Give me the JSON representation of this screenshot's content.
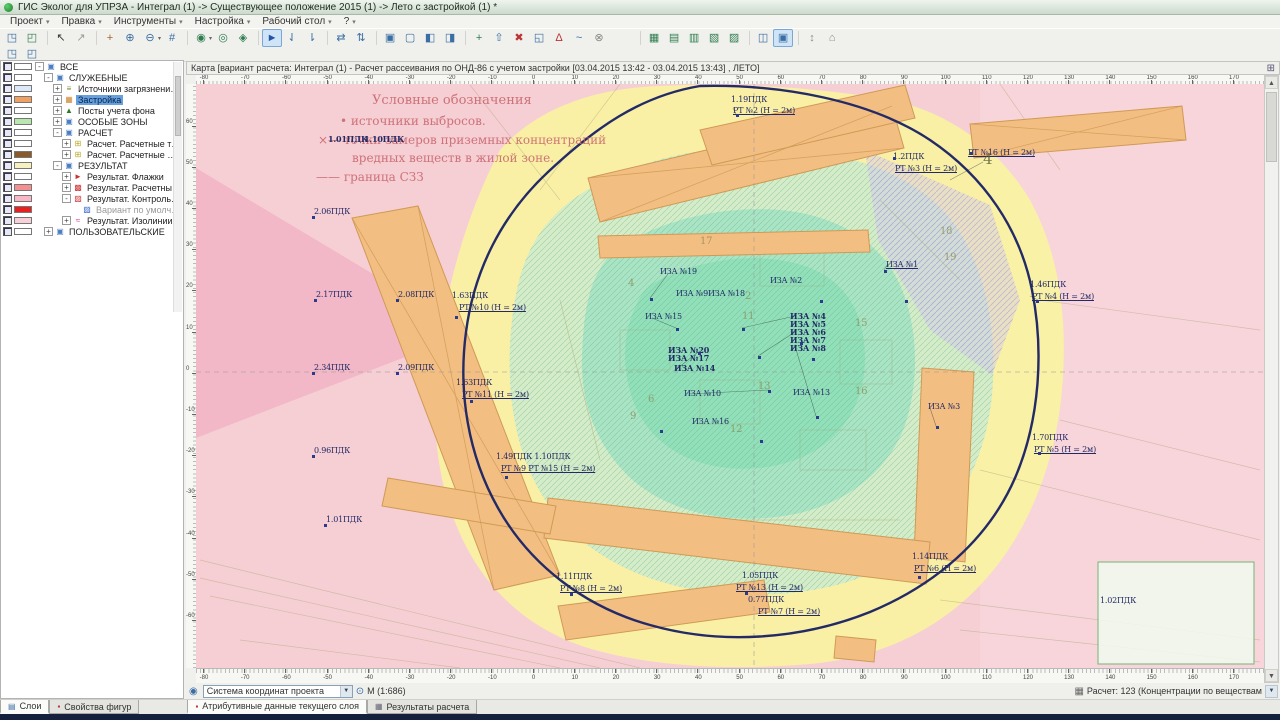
{
  "window": {
    "title": "ГИС Эколог для УПРЗА - Интеграл (1) -> Существующее положение 2015 (1) -> Лето с застройкой (1) *"
  },
  "menu": {
    "items": [
      "Проект",
      "Правка",
      "Инструменты",
      "Настройка",
      "Рабочий стол",
      "?"
    ]
  },
  "toolbar": {
    "rows": [
      [
        [
          {
            "g": "◳",
            "c": "#3a6ea5"
          },
          {
            "g": "◰",
            "c": "#2e7d4f"
          }
        ],
        [
          {
            "g": "↖",
            "c": "#333333"
          },
          {
            "g": "↗",
            "c": "#999999"
          }
        ],
        [
          {
            "g": "+",
            "c": "#a06a2a"
          },
          {
            "g": "⊕",
            "c": "#3a6ea5"
          },
          {
            "g": "⊖",
            "c": "#3a6ea5",
            "dd": true
          },
          {
            "g": "#",
            "c": "#3a6ea5"
          }
        ],
        [
          {
            "g": "◉",
            "c": "#2e7d4f",
            "dd": true
          },
          {
            "g": "◎",
            "c": "#2e7d4f"
          },
          {
            "g": "◈",
            "c": "#2e7d4f"
          }
        ],
        [
          {
            "g": "►",
            "c": "#2255aa",
            "boxed": true
          },
          {
            "g": "⇃",
            "c": "#3a6ea5"
          },
          {
            "g": "⇂",
            "c": "#3a6ea5"
          }
        ],
        [
          {
            "g": "⇄",
            "c": "#3a6ea5"
          },
          {
            "g": "⇅",
            "c": "#3a6ea5"
          }
        ],
        [
          {
            "g": "▣",
            "c": "#3a6ea5"
          },
          {
            "g": "▢",
            "c": "#3a6ea5"
          },
          {
            "g": "◧",
            "c": "#3a6ea5"
          },
          {
            "g": "◨",
            "c": "#3a6ea5"
          }
        ],
        [
          {
            "g": "+",
            "c": "#2e7d4f"
          },
          {
            "g": "⇧",
            "c": "#3a6ea5"
          },
          {
            "g": "✖",
            "c": "#bb3333"
          },
          {
            "g": "◱",
            "c": "#3a6ea5"
          },
          {
            "g": "Δ",
            "c": "#bb3333"
          },
          {
            "g": "~",
            "c": "#3a6ea5"
          },
          {
            "g": "⊗",
            "c": "#888888"
          }
        ],
        [
          {
            "gap": true
          }
        ],
        [
          {
            "g": "▦",
            "c": "#2e7d4f"
          },
          {
            "g": "▤",
            "c": "#2e7d4f"
          },
          {
            "g": "▥",
            "c": "#2e7d4f"
          },
          {
            "g": "▧",
            "c": "#2e7d4f"
          },
          {
            "g": "▨",
            "c": "#2e7d4f"
          }
        ],
        [
          {
            "g": "◫",
            "c": "#3a6ea5"
          },
          {
            "g": "▣",
            "c": "#3a6ea5",
            "boxed": true
          }
        ],
        [
          {
            "g": "↕",
            "c": "#888888"
          },
          {
            "g": "⌂",
            "c": "#888888"
          }
        ]
      ],
      [
        [
          {
            "g": "◳",
            "c": "#3a6ea5"
          },
          {
            "g": "◰",
            "c": "#3a6ea5"
          }
        ]
      ]
    ]
  },
  "layers_panel": {
    "tabs": [
      "Слои",
      "Свойства фигур"
    ],
    "tree": [
      {
        "label": "ВСЕ",
        "indent": 0,
        "exp": "-",
        "icon": "folder",
        "swatch": "#ffffff"
      },
      {
        "label": "СЛУЖЕБНЫЕ",
        "indent": 1,
        "exp": "-",
        "icon": "folder",
        "swatch": "#ffffff"
      },
      {
        "label": "Источники загрязнения ат...",
        "indent": 2,
        "exp": "+",
        "icon": "src",
        "swatch": "#dde8f8"
      },
      {
        "label": "Застройка",
        "indent": 2,
        "exp": "+",
        "icon": "bld",
        "swatch": "#f0a060",
        "selected": true
      },
      {
        "label": "Посты учета фона",
        "indent": 2,
        "exp": "+",
        "icon": "post",
        "swatch": "#ffffff"
      },
      {
        "label": "ОСОБЫЕ ЗОНЫ",
        "indent": 2,
        "exp": "+",
        "icon": "folder",
        "swatch": "#b8e8b0"
      },
      {
        "label": "РАСЧЕТ",
        "indent": 2,
        "exp": "-",
        "icon": "folder",
        "swatch": "#ffffff"
      },
      {
        "label": "Расчет. Расчетные точки",
        "indent": 3,
        "exp": "+",
        "icon": "pts",
        "swatch": "#ffffff"
      },
      {
        "label": "Расчет. Расчетные площ...",
        "indent": 3,
        "exp": "+",
        "icon": "pts",
        "swatch": "#8a5a2a"
      },
      {
        "label": "РЕЗУЛЬТАТ",
        "indent": 2,
        "exp": "-",
        "icon": "folder",
        "swatch": "#f8f0c0"
      },
      {
        "label": "Результат. Флажки",
        "indent": 3,
        "exp": "+",
        "icon": "flag",
        "swatch": "#ffffff"
      },
      {
        "label": "Результат. Расчетные т...",
        "indent": 3,
        "exp": "+",
        "icon": "res",
        "swatch": "#f49090"
      },
      {
        "label": "Результат. Контрольный...",
        "indent": 3,
        "exp": "-",
        "icon": "res2",
        "swatch": "#f8b8c8"
      },
      {
        "label": "Вариант по умолчанию",
        "indent": 4,
        "exp": "",
        "icon": "res3",
        "swatch": "#e82020",
        "grayed": true
      },
      {
        "label": "Результат. Изолинии",
        "indent": 3,
        "exp": "+",
        "icon": "iso",
        "swatch": "#f8d0d8"
      },
      {
        "label": "ПОЛЬЗОВАТЕЛЬСКИЕ",
        "indent": 1,
        "exp": "+",
        "icon": "folder",
        "swatch": "#ffffff"
      }
    ]
  },
  "map": {
    "header": "Карта [вариант расчета: Интеграл (1) - Расчет рассеивания по ОНД-86 с учетом застройки [03.04.2015 13:42 - 03.04.2015 13:43] , ЛЕТО]",
    "legend": [
      {
        "x": 372,
        "y": 93,
        "t": "Условные обозначения",
        "fs": 13
      },
      {
        "x": 340,
        "y": 114,
        "t": "•  источники выбросов.",
        "fs": 12
      },
      {
        "x": 318,
        "y": 133,
        "t": "×—  точки замеров приземных концентраций",
        "fs": 12
      },
      {
        "x": 352,
        "y": 151,
        "t": "вредных веществ  в жилой зоне.",
        "fs": 12
      },
      {
        "x": 316,
        "y": 170,
        "t": "——  граница СЗЗ",
        "fs": 12
      }
    ],
    "labels": [
      {
        "x": 731,
        "y": 96,
        "t": "1.19ПДК"
      },
      {
        "x": 733,
        "y": 107,
        "t": "РТ №2 (Н = 2м)",
        "u": true
      },
      {
        "x": 893,
        "y": 153,
        "t": "1.2ПДК"
      },
      {
        "x": 895,
        "y": 165,
        "t": "РТ №3 (Н = 2м)",
        "u": true
      },
      {
        "x": 968,
        "y": 149,
        "t": "РТ №16 (Н = 2м)",
        "u": true
      },
      {
        "x": 1030,
        "y": 281,
        "t": "1.46ПДК"
      },
      {
        "x": 1032,
        "y": 293,
        "t": "РТ №4 (Н = 2м)",
        "u": true
      },
      {
        "x": 1032,
        "y": 434,
        "t": "1.70ПДК"
      },
      {
        "x": 1034,
        "y": 446,
        "t": "РТ №5 (Н = 2м)",
        "u": true
      },
      {
        "x": 314,
        "y": 208,
        "t": "2.06ПДК"
      },
      {
        "x": 316,
        "y": 291,
        "t": "2.17ПДК"
      },
      {
        "x": 398,
        "y": 291,
        "t": "2.08ПДК"
      },
      {
        "x": 314,
        "y": 364,
        "t": "2.34ПДК"
      },
      {
        "x": 398,
        "y": 364,
        "t": "2.09ПДК"
      },
      {
        "x": 314,
        "y": 447,
        "t": "0.96ПДК"
      },
      {
        "x": 326,
        "y": 516,
        "t": "1.01ПДК"
      },
      {
        "x": 452,
        "y": 292,
        "t": "1.63ПДК"
      },
      {
        "x": 459,
        "y": 304,
        "t": "РТ №10 (Н = 2м)",
        "u": true
      },
      {
        "x": 456,
        "y": 379,
        "t": "1.63ПДК"
      },
      {
        "x": 462,
        "y": 391,
        "t": "РТ №11 (Н = 2м)",
        "u": true
      },
      {
        "x": 496,
        "y": 453,
        "t": "1.49ПДК 1.10ПДК"
      },
      {
        "x": 501,
        "y": 465,
        "t": "РТ №9 РТ №15 (Н = 2м)",
        "u": true
      },
      {
        "x": 556,
        "y": 573,
        "t": "1.11ПДК"
      },
      {
        "x": 560,
        "y": 585,
        "t": "РТ №8 (Н = 2м)",
        "u": true
      },
      {
        "x": 742,
        "y": 572,
        "t": "1.05ПДК"
      },
      {
        "x": 736,
        "y": 584,
        "t": "РТ №13 (Н = 2м)",
        "u": true
      },
      {
        "x": 748,
        "y": 596,
        "t": "0.77ПДК"
      },
      {
        "x": 758,
        "y": 608,
        "t": "РТ №7 (Н = 2м)",
        "u": true
      },
      {
        "x": 912,
        "y": 553,
        "t": "1.14ПДК"
      },
      {
        "x": 914,
        "y": 565,
        "t": "РТ №6 (Н = 2м)",
        "u": true
      },
      {
        "x": 1100,
        "y": 597,
        "t": "1.02ПДК"
      },
      {
        "x": 328,
        "y": 135,
        "t": "1.01ПДК",
        "b": true
      },
      {
        "x": 364,
        "y": 135,
        "t": "1.10ПДК",
        "b": true
      },
      {
        "x": 886,
        "y": 261,
        "t": "ИЗА №1",
        "u": true
      },
      {
        "x": 660,
        "y": 268,
        "t": "ИЗА №19"
      },
      {
        "x": 676,
        "y": 290,
        "t": "ИЗА №9ИЗА №18"
      },
      {
        "x": 770,
        "y": 277,
        "t": "ИЗА №2"
      },
      {
        "x": 645,
        "y": 313,
        "t": "ИЗА №15"
      },
      {
        "x": 790,
        "y": 312,
        "t": "ИЗА №4",
        "b": true
      },
      {
        "x": 790,
        "y": 320,
        "t": "ИЗА №5",
        "b": true
      },
      {
        "x": 790,
        "y": 328,
        "t": "ИЗА №6",
        "b": true
      },
      {
        "x": 790,
        "y": 336,
        "t": "ИЗА №7",
        "b": true
      },
      {
        "x": 790,
        "y": 344,
        "t": "ИЗА №8",
        "b": true
      },
      {
        "x": 668,
        "y": 346,
        "t": "ИЗА №20",
        "b": true
      },
      {
        "x": 668,
        "y": 354,
        "t": "ИЗА №17",
        "b": true
      },
      {
        "x": 674,
        "y": 364,
        "t": "ИЗА №14",
        "b": true
      },
      {
        "x": 684,
        "y": 390,
        "t": "ИЗА №10"
      },
      {
        "x": 793,
        "y": 389,
        "t": "ИЗА №13"
      },
      {
        "x": 692,
        "y": 418,
        "t": "ИЗА №16"
      },
      {
        "x": 928,
        "y": 403,
        "t": "ИЗА №3"
      },
      {
        "x": 983,
        "y": 155,
        "t": "4",
        "big": true
      },
      {
        "x": 940,
        "y": 228,
        "t": "18",
        "dim": true
      },
      {
        "x": 944,
        "y": 254,
        "t": "19",
        "dim": true
      },
      {
        "x": 700,
        "y": 238,
        "t": "17",
        "dim": true
      },
      {
        "x": 745,
        "y": 293,
        "t": "2",
        "dim": true
      },
      {
        "x": 742,
        "y": 313,
        "t": "11",
        "dim": true
      },
      {
        "x": 628,
        "y": 280,
        "t": "4",
        "dim": true
      },
      {
        "x": 855,
        "y": 320,
        "t": "15",
        "dim": true
      },
      {
        "x": 630,
        "y": 413,
        "t": "9",
        "dim": true
      },
      {
        "x": 758,
        "y": 383,
        "t": "13",
        "dim": true
      },
      {
        "x": 648,
        "y": 396,
        "t": "6",
        "dim": true
      },
      {
        "x": 730,
        "y": 426,
        "t": "12",
        "dim": true
      },
      {
        "x": 855,
        "y": 388,
        "t": "16",
        "dim": true
      }
    ],
    "markers": [
      [
        650,
        298
      ],
      [
        676,
        328
      ],
      [
        698,
        352
      ],
      [
        742,
        328
      ],
      [
        758,
        356
      ],
      [
        800,
        342
      ],
      [
        812,
        358
      ],
      [
        768,
        390
      ],
      [
        816,
        416
      ],
      [
        936,
        426
      ],
      [
        884,
        270
      ],
      [
        736,
        114
      ],
      [
        660,
        430
      ],
      [
        760,
        440
      ],
      [
        905,
        300
      ],
      [
        820,
        300
      ],
      [
        570,
        593
      ],
      [
        745,
        592
      ],
      [
        918,
        576
      ],
      [
        1036,
        300
      ],
      [
        1038,
        452
      ],
      [
        505,
        476
      ],
      [
        470,
        400
      ],
      [
        455,
        316
      ],
      [
        312,
        216
      ],
      [
        314,
        299
      ],
      [
        396,
        299
      ],
      [
        312,
        372
      ],
      [
        396,
        372
      ],
      [
        312,
        455
      ],
      [
        324,
        524
      ],
      [
        893,
        157
      ],
      [
        970,
        152
      ]
    ],
    "ruler": {
      "h_start": -80,
      "h_end": 170,
      "step": 10,
      "v_start": 60,
      "v_end": -60
    }
  },
  "statusbar": {
    "coord_system": "Система координат проекта",
    "scale": "М (1:686)",
    "result_selector": "Расчет: 123 (Концентрации по веществам"
  },
  "bottom_tabs": [
    "Атрибутивные данные текущего слоя",
    "Результаты расчета"
  ]
}
